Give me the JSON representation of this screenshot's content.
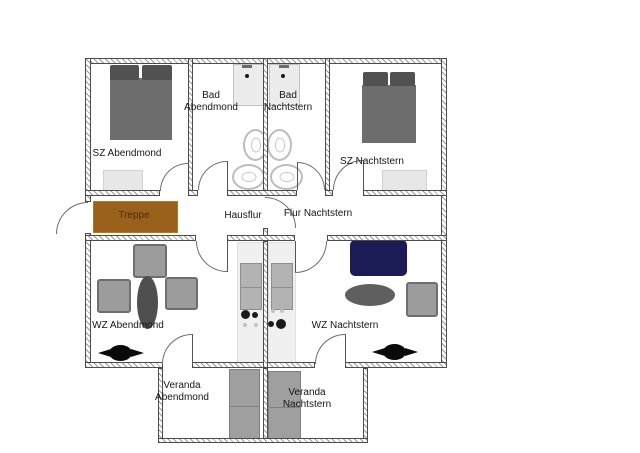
{
  "plan": {
    "rooms": {
      "sz_abendmond": "SZ Abendmond",
      "bad_abendmond_l1": "Bad",
      "bad_abendmond_l2": "Abendmond",
      "bad_nachtstern_l1": "Bad",
      "bad_nachtstern_l2": "Nachtstern",
      "sz_nachtstern": "SZ Nachtstern",
      "treppe": "Treppe",
      "hausflur": "Hausflur",
      "flur_nachtstern": "Flur Nachtstern",
      "wz_abendmond": "WZ Abendmond",
      "wz_nachtstern": "WZ Nachtstern",
      "veranda_abendmond_l1": "Veranda",
      "veranda_abendmond_l2": "Abendmond",
      "veranda_nachtstern_l1": "Veranda",
      "veranda_nachtstern_l2": "Nachtstern"
    },
    "colors": {
      "stairs": "#99611b",
      "stairs_text": "#4d2e05",
      "sofa": "#1b1b55",
      "bed": "#6d6d6d",
      "pillow": "#515151",
      "table_dark": "#4f4f4f",
      "table_mid": "#5f5f5f",
      "chair": "#9c9c9c",
      "bench": "#9f9f9f",
      "wall_outline": "#4c4c4c"
    }
  }
}
